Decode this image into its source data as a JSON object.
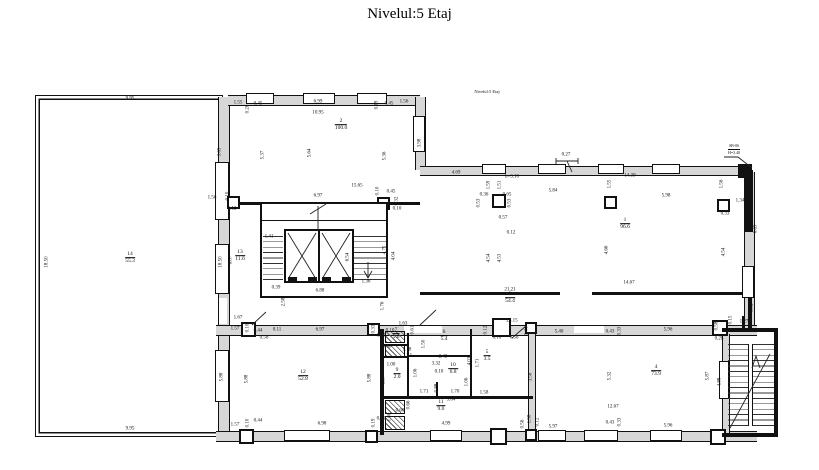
{
  "title": "Nivelul:5 Etaj",
  "note": "Nivelul:5 Etaj",
  "corner": {
    "l1": "SB-06",
    "l2": "H=3.40"
  },
  "colors": {
    "wall_black": "#111111",
    "wall_gray": "#d7d7d7",
    "paper": "#ffffff"
  },
  "rooms": [
    {
      "num": "14",
      "area": "55.3",
      "x": 130,
      "y": 258
    },
    {
      "num": "13",
      "area": "11.6",
      "x": 240,
      "y": 256
    },
    {
      "num": "2",
      "area": "100.0",
      "x": 341,
      "y": 125
    },
    {
      "num": "1",
      "area": "96.6",
      "x": 625,
      "y": 224
    },
    {
      "num": "3",
      "area": "54.4",
      "x": 510,
      "y": 298
    },
    {
      "num": "12",
      "area": "52.8",
      "x": 303,
      "y": 376
    },
    {
      "num": "4",
      "area": "73.9",
      "x": 656,
      "y": 371
    },
    {
      "num": "6",
      "area": "5.4",
      "x": 444,
      "y": 336
    },
    {
      "num": "5",
      "area": "3.5",
      "x": 487,
      "y": 356
    },
    {
      "num": "10",
      "area": "6.8",
      "x": 453,
      "y": 369
    },
    {
      "num": "9",
      "area": "2.0",
      "x": 397,
      "y": 374
    },
    {
      "num": "11",
      "area": "9.0",
      "x": 441,
      "y": 406
    },
    {
      "num": "7",
      "area": "1.6",
      "x": 396,
      "y": 334
    }
  ],
  "dims": [
    {
      "t": "9.95",
      "x": 130,
      "y": 99
    },
    {
      "t": "18.50",
      "x": 47,
      "y": 262,
      "r": 1
    },
    {
      "t": "18.50",
      "x": 221,
      "y": 262,
      "r": 1
    },
    {
      "t": "6.87",
      "x": 231,
      "y": 260,
      "r": 1
    },
    {
      "t": "9.95",
      "x": 130,
      "y": 429
    },
    {
      "t": "1.55",
      "x": 238,
      "y": 103
    },
    {
      "t": "0.20",
      "x": 248,
      "y": 109,
      "r": 1
    },
    {
      "t": "0.45",
      "x": 258,
      "y": 104
    },
    {
      "t": "6.99",
      "x": 318,
      "y": 102
    },
    {
      "t": "10.95",
      "x": 318,
      "y": 113
    },
    {
      "t": "0.19",
      "x": 377,
      "y": 105,
      "r": 1
    },
    {
      "t": "0.45",
      "x": 389,
      "y": 104
    },
    {
      "t": "1.56",
      "x": 404,
      "y": 102
    },
    {
      "t": "3.65",
      "x": 220,
      "y": 152,
      "r": 1
    },
    {
      "t": "5.37",
      "x": 263,
      "y": 155,
      "r": 1
    },
    {
      "t": "5.64",
      "x": 310,
      "y": 153,
      "r": 1
    },
    {
      "t": "5.36",
      "x": 385,
      "y": 156,
      "r": 1
    },
    {
      "t": "3.98",
      "x": 420,
      "y": 143,
      "r": 1
    },
    {
      "t": "15.65",
      "x": 357,
      "y": 186
    },
    {
      "t": "6.97",
      "x": 318,
      "y": 196
    },
    {
      "t": "0.10",
      "x": 378,
      "y": 191,
      "r": 1
    },
    {
      "t": "0.45",
      "x": 391,
      "y": 192
    },
    {
      "t": "0.32",
      "x": 397,
      "y": 201,
      "r": 1
    },
    {
      "t": "0.10",
      "x": 397,
      "y": 209
    },
    {
      "t": "1.56",
      "x": 212,
      "y": 198
    },
    {
      "t": "0.10",
      "x": 228,
      "y": 196,
      "r": 1
    },
    {
      "t": "0.12",
      "x": 232,
      "y": 209
    },
    {
      "t": "1.41",
      "x": 269,
      "y": 237
    },
    {
      "t": "6.54",
      "x": 348,
      "y": 257,
      "r": 1
    },
    {
      "t": "4.75",
      "x": 385,
      "y": 250,
      "r": 1
    },
    {
      "t": "4.04",
      "x": 394,
      "y": 256,
      "r": 1
    },
    {
      "t": "1.36",
      "x": 366,
      "y": 282
    },
    {
      "t": "0.39",
      "x": 276,
      "y": 288
    },
    {
      "t": "6.88",
      "x": 320,
      "y": 291
    },
    {
      "t": "2.58",
      "x": 284,
      "y": 302,
      "r": 1
    },
    {
      "t": "1.76",
      "x": 383,
      "y": 306,
      "r": 1
    },
    {
      "t": "4.69",
      "x": 456,
      "y": 173
    },
    {
      "t": "0.27",
      "x": 566,
      "y": 155
    },
    {
      "t": "h=3.10",
      "x": 512,
      "y": 177
    },
    {
      "t": "1.59",
      "x": 489,
      "y": 185,
      "r": 1
    },
    {
      "t": "1.51",
      "x": 500,
      "y": 185,
      "r": 1
    },
    {
      "t": "0.36",
      "x": 484,
      "y": 195
    },
    {
      "t": "0.65",
      "x": 507,
      "y": 195
    },
    {
      "t": "0.53",
      "x": 479,
      "y": 203,
      "r": 1
    },
    {
      "t": "0.53",
      "x": 510,
      "y": 203,
      "r": 1
    },
    {
      "t": "0.57",
      "x": 503,
      "y": 218
    },
    {
      "t": "0.12",
      "x": 511,
      "y": 233
    },
    {
      "t": "4.54",
      "x": 489,
      "y": 258,
      "r": 1
    },
    {
      "t": "4.53",
      "x": 500,
      "y": 258,
      "r": 1
    },
    {
      "t": "5.84",
      "x": 553,
      "y": 191
    },
    {
      "t": "1.55",
      "x": 610,
      "y": 184,
      "r": 1
    },
    {
      "t": "14.39",
      "x": 630,
      "y": 176
    },
    {
      "t": "5.98",
      "x": 666,
      "y": 196
    },
    {
      "t": "1.56",
      "x": 722,
      "y": 184,
      "r": 1
    },
    {
      "t": "1.34",
      "x": 740,
      "y": 201
    },
    {
      "t": "0.33",
      "x": 725,
      "y": 214
    },
    {
      "t": "6.65",
      "x": 756,
      "y": 229,
      "r": 1
    },
    {
      "t": "4.66",
      "x": 607,
      "y": 250,
      "r": 1
    },
    {
      "t": "4.54",
      "x": 724,
      "y": 252,
      "r": 1
    },
    {
      "t": "14.67",
      "x": 629,
      "y": 283
    },
    {
      "t": "21.21",
      "x": 510,
      "y": 290
    },
    {
      "t": "28.15",
      "x": 512,
      "y": 321
    },
    {
      "t": "0.12",
      "x": 486,
      "y": 330,
      "r": 1
    },
    {
      "t": "0.10",
      "x": 497,
      "y": 338
    },
    {
      "t": "0.56",
      "x": 514,
      "y": 338
    },
    {
      "t": "0.44",
      "x": 527,
      "y": 331,
      "r": 1
    },
    {
      "t": "5.40",
      "x": 559,
      "y": 332
    },
    {
      "t": "1.67",
      "x": 238,
      "y": 318
    },
    {
      "t": "1.57",
      "x": 235,
      "y": 329
    },
    {
      "t": "0.10",
      "x": 248,
      "y": 328,
      "r": 1
    },
    {
      "t": "0.44",
      "x": 258,
      "y": 331
    },
    {
      "t": "0.11",
      "x": 277,
      "y": 330
    },
    {
      "t": "0.56",
      "x": 264,
      "y": 338
    },
    {
      "t": "6.97",
      "x": 320,
      "y": 330
    },
    {
      "t": "0.33",
      "x": 374,
      "y": 329,
      "r": 1
    },
    {
      "t": "0.10",
      "x": 381,
      "y": 336
    },
    {
      "t": "5.88",
      "x": 222,
      "y": 377,
      "r": 1
    },
    {
      "t": "5.88",
      "x": 247,
      "y": 379,
      "r": 1
    },
    {
      "t": "5.88",
      "x": 370,
      "y": 378,
      "r": 1
    },
    {
      "t": "5.37",
      "x": 384,
      "y": 380,
      "r": 1
    },
    {
      "t": "1.57",
      "x": 235,
      "y": 425
    },
    {
      "t": "0.10",
      "x": 248,
      "y": 423,
      "r": 1
    },
    {
      "t": "0.44",
      "x": 258,
      "y": 421
    },
    {
      "t": "6.98",
      "x": 322,
      "y": 424
    },
    {
      "t": "0.19",
      "x": 374,
      "y": 423,
      "r": 1
    },
    {
      "t": "0.10",
      "x": 381,
      "y": 419
    },
    {
      "t": "4.99",
      "x": 446,
      "y": 424
    },
    {
      "t": "1.58",
      "x": 530,
      "y": 419,
      "r": 1
    },
    {
      "t": "0.56",
      "x": 523,
      "y": 424,
      "r": 1
    },
    {
      "t": "0.12",
      "x": 538,
      "y": 422,
      "r": 1
    },
    {
      "t": "1.63",
      "x": 403,
      "y": 324
    },
    {
      "t": "0.10",
      "x": 390,
      "y": 331
    },
    {
      "t": "0.61",
      "x": 413,
      "y": 330,
      "r": 1
    },
    {
      "t": "0.08",
      "x": 387,
      "y": 347
    },
    {
      "t": "1.18",
      "x": 407,
      "y": 350
    },
    {
      "t": "1.1",
      "x": 409,
      "y": 356
    },
    {
      "t": "1.50",
      "x": 424,
      "y": 344,
      "r": 1
    },
    {
      "t": "2.42",
      "x": 443,
      "y": 357
    },
    {
      "t": "1.00",
      "x": 391,
      "y": 365
    },
    {
      "t": "3.32",
      "x": 436,
      "y": 364
    },
    {
      "t": "0.10",
      "x": 439,
      "y": 372
    },
    {
      "t": "4.03",
      "x": 470,
      "y": 361,
      "r": 1
    },
    {
      "t": "1.71",
      "x": 478,
      "y": 363,
      "r": 1
    },
    {
      "t": "1.06",
      "x": 416,
      "y": 373,
      "r": 1
    },
    {
      "t": "0.88",
      "x": 437,
      "y": 388,
      "r": 1
    },
    {
      "t": "1.06",
      "x": 467,
      "y": 382,
      "r": 1
    },
    {
      "t": "1.71",
      "x": 424,
      "y": 392
    },
    {
      "t": "1.70",
      "x": 455,
      "y": 392
    },
    {
      "t": "1.58",
      "x": 484,
      "y": 393
    },
    {
      "t": "5.04",
      "x": 451,
      "y": 400
    },
    {
      "t": "0.66",
      "x": 409,
      "y": 405,
      "r": 1
    },
    {
      "t": "0.60",
      "x": 400,
      "y": 411
    },
    {
      "t": "1.00",
      "x": 390,
      "y": 417,
      "r": 1
    },
    {
      "t": "3.58",
      "x": 531,
      "y": 377,
      "r": 1
    },
    {
      "t": "0.43",
      "x": 610,
      "y": 332
    },
    {
      "t": "0.33",
      "x": 620,
      "y": 331,
      "r": 1
    },
    {
      "t": "5.96",
      "x": 668,
      "y": 330
    },
    {
      "t": "0.15",
      "x": 731,
      "y": 320,
      "r": 1
    },
    {
      "t": "0.58",
      "x": 717,
      "y": 326,
      "r": 1
    },
    {
      "t": "0.28",
      "x": 719,
      "y": 339
    },
    {
      "t": "1.27",
      "x": 744,
      "y": 322
    },
    {
      "t": "1.92",
      "x": 752,
      "y": 308,
      "r": 1
    },
    {
      "t": "5.32",
      "x": 610,
      "y": 376,
      "r": 1
    },
    {
      "t": "5.87",
      "x": 708,
      "y": 376,
      "r": 1
    },
    {
      "t": "4.88",
      "x": 720,
      "y": 382,
      "r": 1
    },
    {
      "t": "12.67",
      "x": 613,
      "y": 407
    },
    {
      "t": "5.97",
      "x": 553,
      "y": 427
    },
    {
      "t": "0.43",
      "x": 610,
      "y": 423
    },
    {
      "t": "0.33",
      "x": 620,
      "y": 422,
      "r": 1
    },
    {
      "t": "5.96",
      "x": 668,
      "y": 426
    }
  ]
}
